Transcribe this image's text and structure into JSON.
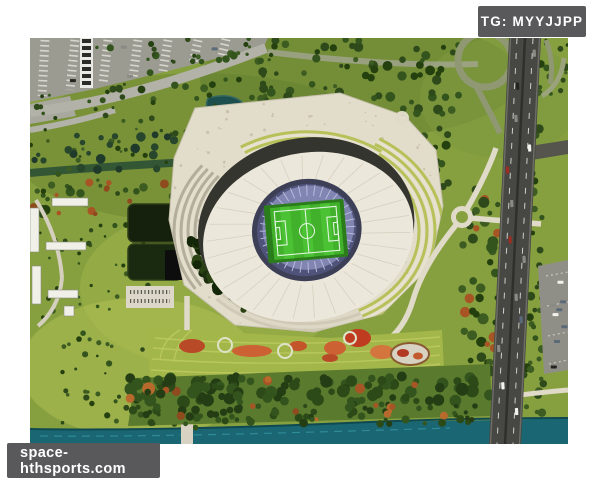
{
  "watermarks": {
    "telegram": {
      "label": "TG: MYYJJPP"
    },
    "website": {
      "label": "space-hthsports.com"
    }
  },
  "photo": {
    "description": "Aerial architectural rendering of an oval white-roofed football stadium with a green pitch, surrounded by a terraced plaza, parkland with trees, a pond, a parking lot, a river along the bottom and a highway interchange on the right",
    "palette": {
      "page_background": "#ffffff",
      "badge_background": "#59595b",
      "badge_text": "#ffffff",
      "meadow_green": "#87a03f",
      "pitch_green": "#41b02a",
      "roof_white": "#ebe7da",
      "bowl_blue": "#8185b1",
      "water_teal": "#1a6672",
      "asphalt_gray": "#474743",
      "plaza_cream": "#e2ddcb"
    }
  }
}
